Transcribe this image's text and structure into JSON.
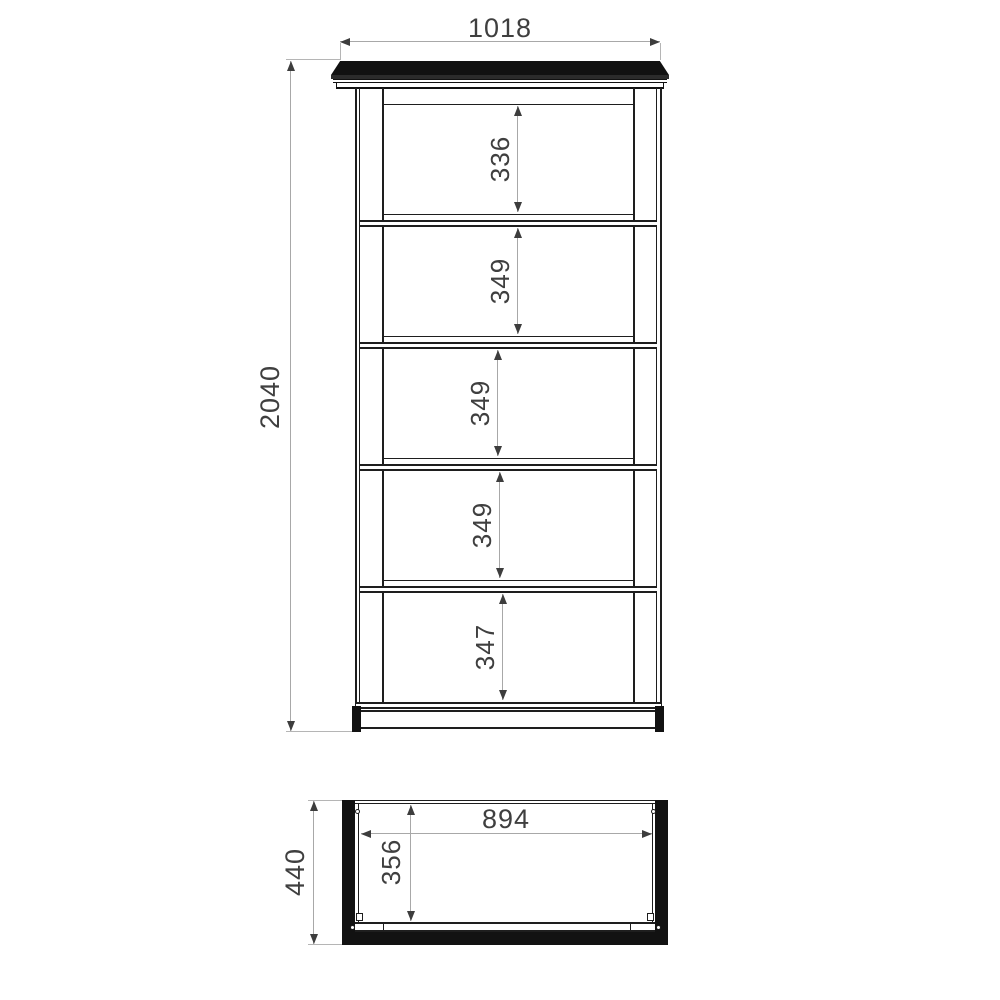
{
  "front_view": {
    "width_label": "1018",
    "height_label": "2040",
    "shelf_labels": [
      "336",
      "349",
      "349",
      "349",
      "347"
    ]
  },
  "plan_view": {
    "depth_label": "440",
    "inner_width_label": "894",
    "inner_depth_label": "356"
  },
  "colors": {
    "drawing_line": "#1e1e1e",
    "dimension_line": "#a8a8a8",
    "text": "#3f3f3f",
    "background": "#ffffff"
  }
}
